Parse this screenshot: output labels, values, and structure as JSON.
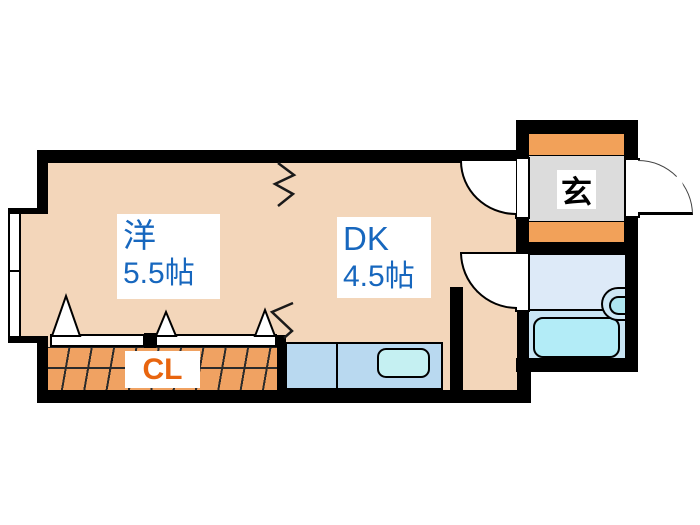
{
  "plan": {
    "type": "apartment-floor-plan",
    "rooms": [
      {
        "id": "western",
        "name": "洋",
        "size": "5.5帖"
      },
      {
        "id": "dk",
        "name": "DK",
        "size": "4.5帖"
      }
    ],
    "closet": {
      "label": "CL"
    },
    "entrance": {
      "label": "玄"
    },
    "colors": {
      "floor": "#F3D6BA",
      "wall": "#000000",
      "closet_fill": "#F0A262",
      "closet_text": "#E8650F",
      "shoe_cabinet": "#F2A159",
      "genkan_floor": "#DCDCDC",
      "bath_floor_upper": "#DDEAF8",
      "bath_floor_lower": "#C9E5F4",
      "bathtub": "#B3ECF7",
      "counter": "#B9D9F0",
      "counter_sink": "#C5F0F2",
      "room_text": "#1767BE"
    }
  }
}
